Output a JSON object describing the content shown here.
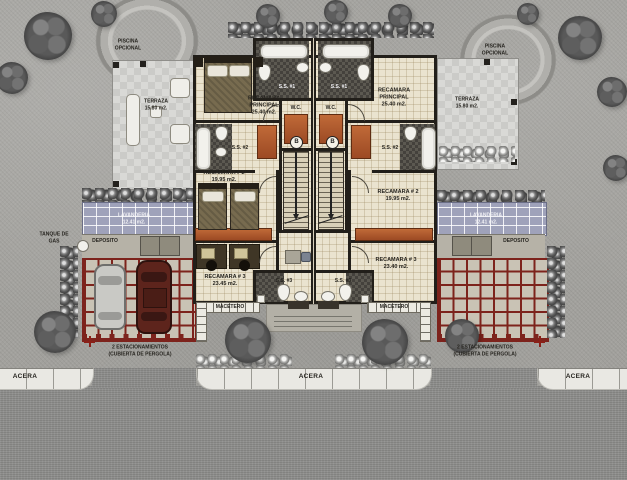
{
  "site": {
    "acera": "ACERA",
    "tanque_line1": "TANQUE DE",
    "tanque_line2": "GAS"
  },
  "colors": {
    "wall": "#221f1a",
    "floor": "#eae3cf",
    "closet_accent": "#b05a2e",
    "pergola_red": "#7d231c",
    "lavanderia_roof": "#9fa2ba"
  },
  "left": {
    "piscina_line1": "PISCINA",
    "piscina_line2": "OPCIONAL",
    "terraza_name": "TERRAZA",
    "terraza_area": "15.80 m2.",
    "recamara_principal_name1": "RECAMARA",
    "recamara_principal_name2": "PRINCIPAL",
    "recamara_principal_area": "25.40 m2.",
    "ss1": "S.S. #1",
    "wc": "W.C.",
    "ss2": "S.S. #2",
    "ss3": "S.S. #3",
    "recamara2_name": "RECAMARA # 2",
    "recamara2_area": "19.95 m2.",
    "recamara3_name": "RECAMARA # 3",
    "recamara3_area": "23.45 m2.",
    "lavanderia_name": "LAVANDERIA",
    "lavanderia_area": "12.41 m2.",
    "deposito": "DEPOSITO",
    "parking_line1": "2 ESTACIONAMIENTOS",
    "parking_line2": "(CUBIERTA DE PERGOLA)",
    "macetero": "MACETERO",
    "stair_direction": "B"
  },
  "right": {
    "piscina_line1": "PISCINA",
    "piscina_line2": "OPCIONAL",
    "terraza_name": "TERRAZA",
    "terraza_area": "15.80 m2.",
    "recamara_principal_name1": "RECAMARA",
    "recamara_principal_name2": "PRINCIPAL",
    "recamara_principal_area": "25.40 m2.",
    "ss1": "S.S. #1",
    "wc": "W.C.",
    "ss2": "S.S. #2",
    "ss3": "S.S. #3",
    "recamara2_name": "RECAMARA # 2",
    "recamara2_area": "19.95 m2.",
    "recamara3_name": "RECAMARA # 3",
    "recamara3_area": "23.40 m2.",
    "lavanderia_name": "LAVANDERIA",
    "lavanderia_area": "12.41 m2.",
    "deposito": "DEPOSITO",
    "parking_line1": "2 ESTACIONAMIENTOS",
    "parking_line2": "(CUBIERTA DE PERGOLA)",
    "macetero": "MACETERO",
    "stair_direction": "B"
  }
}
